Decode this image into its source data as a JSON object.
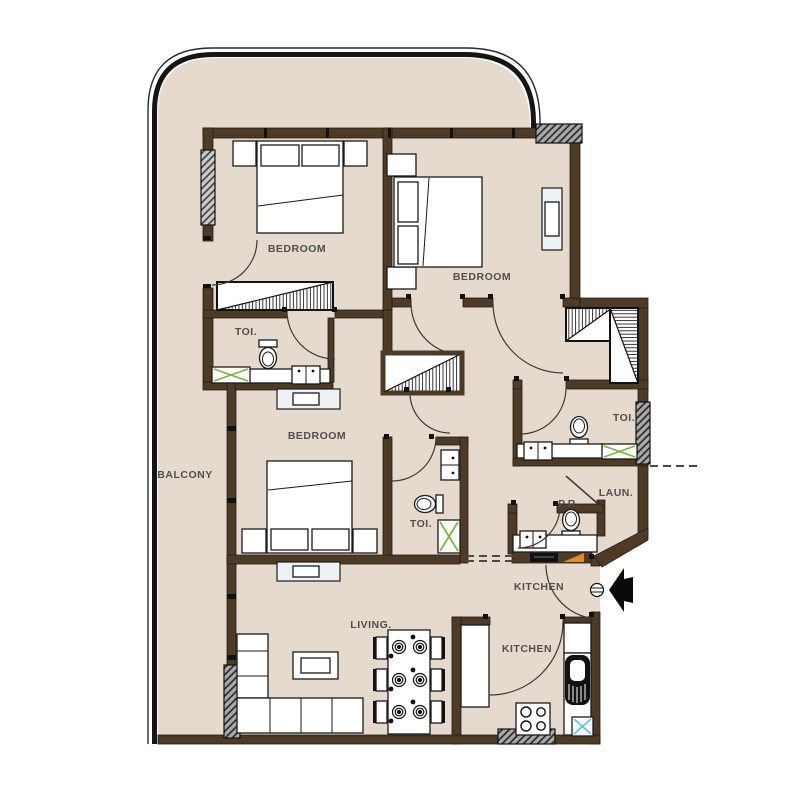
{
  "plan_type": "apartment-floor-plan",
  "rooms": {
    "bedroom_1": "BEDROOM",
    "bedroom_2": "BEDROOM",
    "bedroom_3": "BEDROOM",
    "toilet_1": "TOI.",
    "toilet_2": "TOI.",
    "toilet_3": "TOI.",
    "balcony": "BALCONY",
    "living": "LIVING.",
    "kitchen_hall": "KITCHEN",
    "kitchen": "KITCHEN",
    "laundry": "LAUN.",
    "powder_room": "P.R"
  },
  "colors": {
    "floor": "#e5dacd",
    "wall": "#4d3b27",
    "outline": "#1a1a1a",
    "label": "#4f4f4f",
    "shower_x": "#7cb342",
    "drain_x": "#5fc0e8",
    "cabinet_accent": "#e08b2d",
    "console": "#eef2f5"
  }
}
